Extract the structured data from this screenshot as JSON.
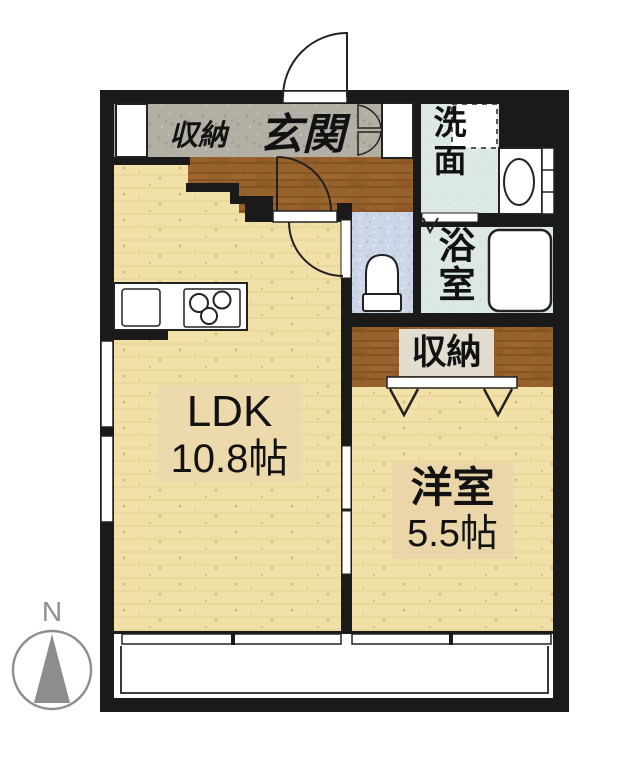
{
  "plan": {
    "entry": {
      "label": "玄関",
      "storage_label": "収納"
    },
    "washroom": {
      "label": "洗面"
    },
    "bathroom": {
      "label": "浴室"
    },
    "closet": {
      "label": "収納"
    },
    "ldk": {
      "label": "LDK",
      "size": "10.8帖"
    },
    "western_room": {
      "label": "洋室",
      "size": "5.5帖"
    },
    "compass": {
      "north": "N"
    }
  },
  "colors": {
    "wall": "#1a1a1a",
    "light_wood_floor": "#f1e1a8",
    "dark_wood_floor": "#98622c",
    "entry_stone_floor": "#b4afa5",
    "wet_area_floor": "#dce8e3",
    "toilet_floor": "#cdd6e7",
    "label_box_tan": "#ecd8ac",
    "label_box_beige": "#e3ddd0",
    "compass_gray": "#8f8f8f"
  }
}
